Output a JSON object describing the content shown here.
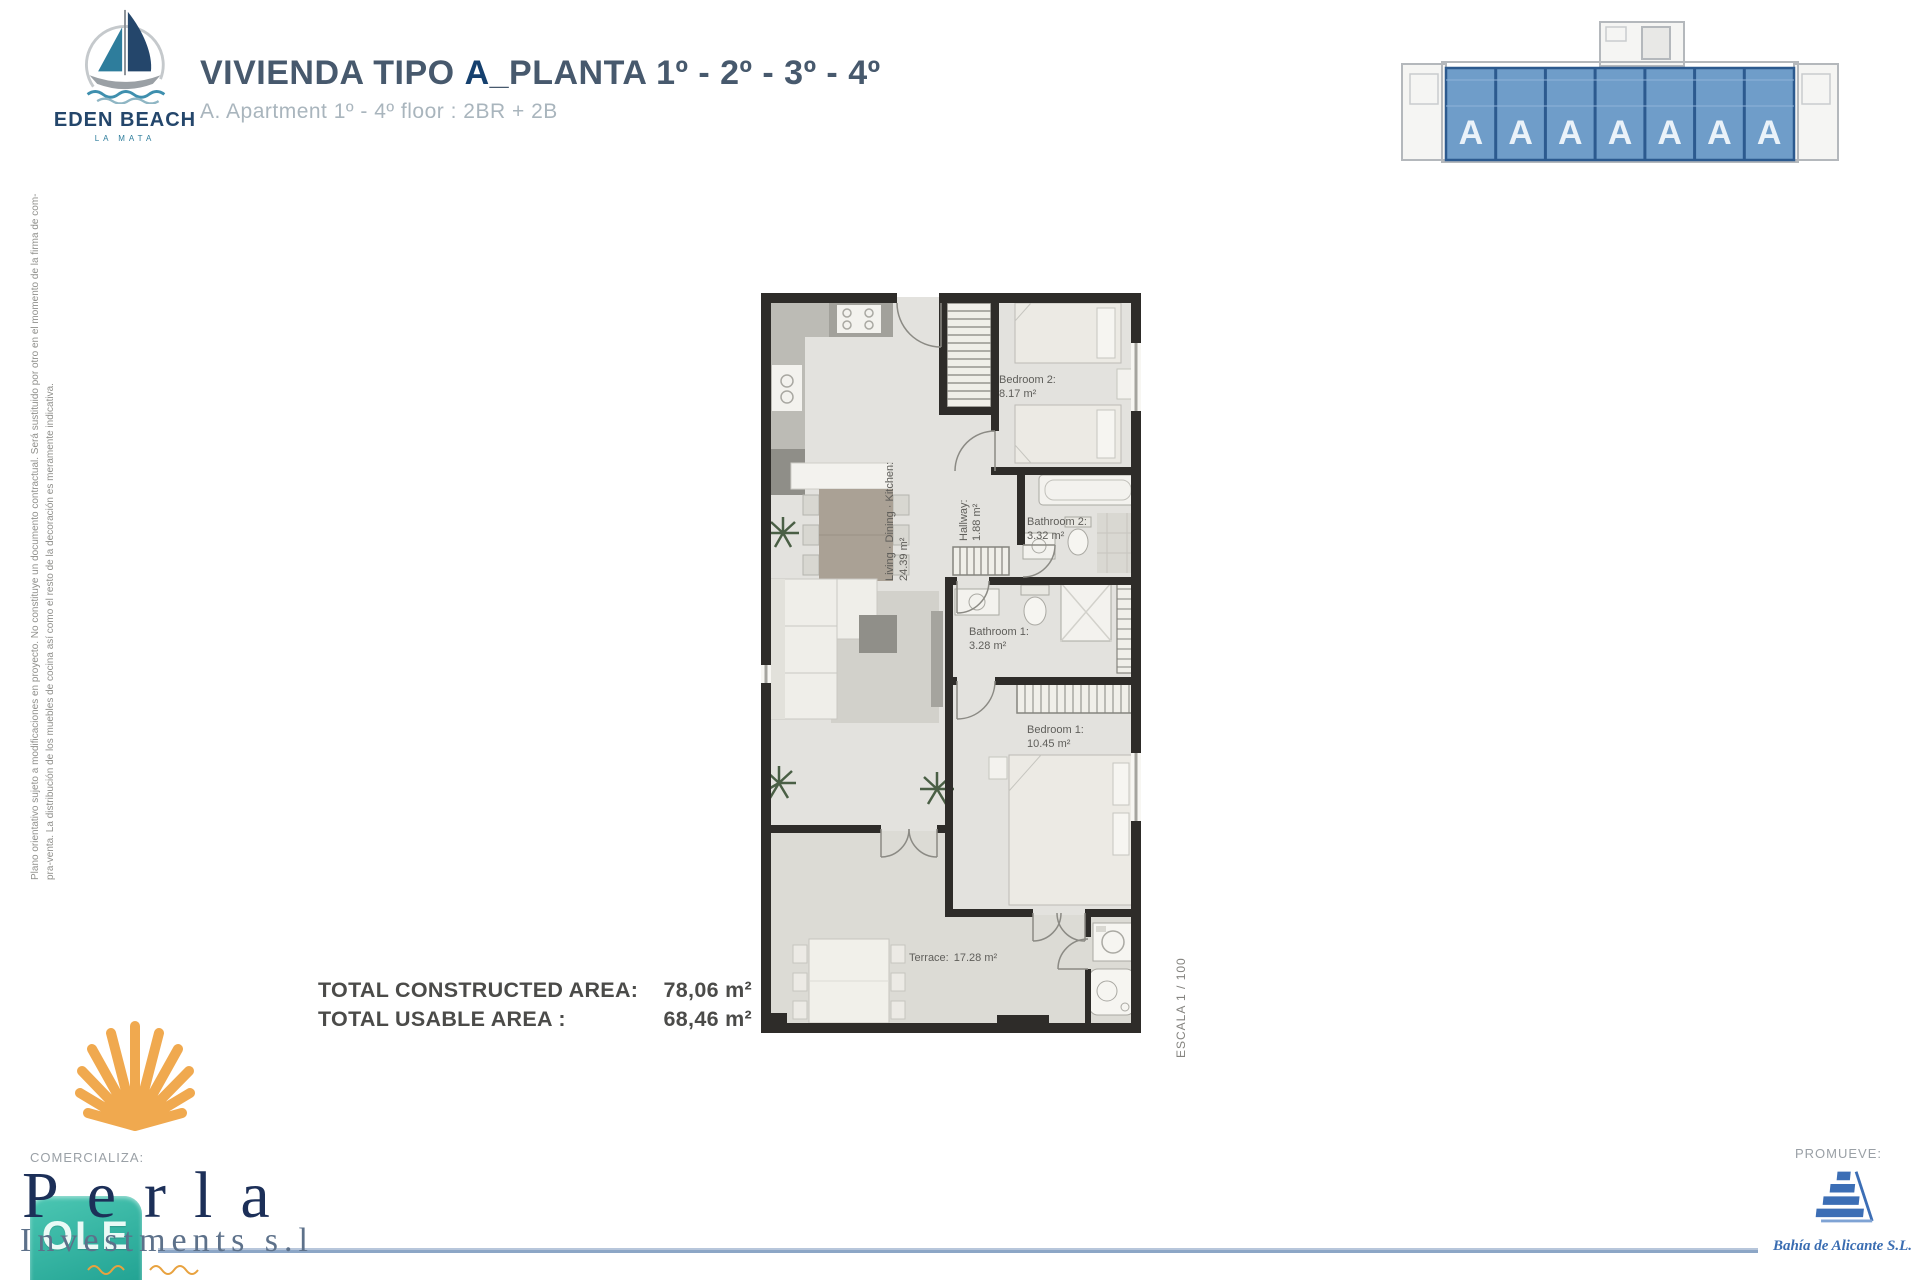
{
  "colors": {
    "wall": "#2e2c29",
    "floor": "#e3e2de",
    "terrace_floor": "#dcdbd5",
    "key_plan_unit_fill": "#6f9dc9",
    "key_plan_divider": "#2c5a8f",
    "brand_navy": "#24466b",
    "brand_teal": "#2e7d9c",
    "title_navy": "#47596d",
    "shell_orange": "#f0a94f",
    "seller_navy": "#1c2f58",
    "ole_teal": "#1a9c8d",
    "developer_blue": "#3a6db2",
    "footer_line": "#8ca6c6"
  },
  "brand": {
    "name": "EDEN BEACH",
    "tagline": "LA MATA"
  },
  "header": {
    "title_prefix": "VIVIENDA TIPO ",
    "title_emphasis": "A",
    "title_suffix": "_PLANTA 1º - 2º - 3º - 4º",
    "subtitle": "A. Apartment 1º - 4º floor : 2BR + 2B"
  },
  "key_plan": {
    "units": [
      "A",
      "A",
      "A",
      "A",
      "A",
      "A",
      "A"
    ]
  },
  "floor_plan": {
    "scale_label": "ESCALA 1 / 100",
    "rooms": {
      "bedroom2": {
        "label": "Bedroom 2:",
        "area": "8.17 m²"
      },
      "bathroom2": {
        "label": "Bathroom 2:",
        "area": "3.32 m²"
      },
      "hallway": {
        "label": "Hallway:",
        "area": "1.88 m²"
      },
      "bathroom1": {
        "label": "Bathroom 1:",
        "area": "3.28 m²"
      },
      "bedroom1": {
        "label": "Bedroom 1:",
        "area": "10.45 m²"
      },
      "living": {
        "label": "Living · Dining · Kitchen:",
        "area": "24.39 m²"
      },
      "terrace": {
        "label": "Terrace:",
        "area": "17.28 m²"
      }
    }
  },
  "totals": {
    "constructed_label": "TOTAL CONSTRUCTED AREA:",
    "constructed_value": "78,06 m²",
    "usable_label": "TOTAL USABLE AREA :",
    "usable_value": "68,46 m²"
  },
  "disclaimer": {
    "line1": "Plano orientativo sujeto a modificaciones en proyecto. No constituye un documento contractual. Será sustituido por otro en el momento de la firma de com-",
    "line2": "pra-venta. La distribución de los muebles de cocina así como el resto de la decoración es meramente indicativa."
  },
  "footer": {
    "comercializa_label": "COMERCIALIZA:",
    "seller_name": "Perla",
    "seller_subname": "Investments s.l",
    "seller_badge": "OLE",
    "promueve_label": "PROMUEVE:",
    "developer_name": "Bahía de Alicante S.L."
  }
}
